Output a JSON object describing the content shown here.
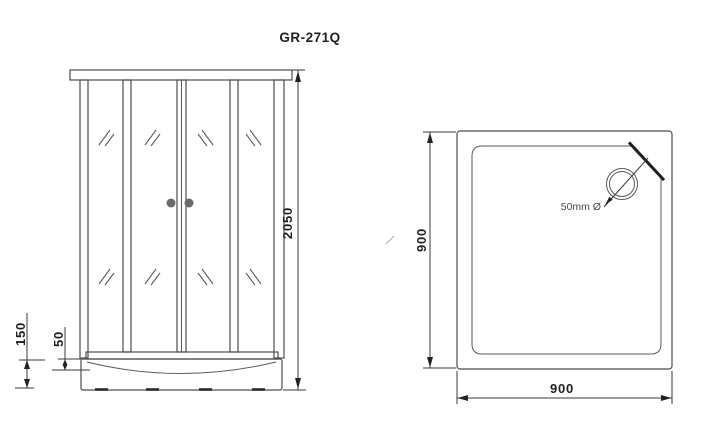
{
  "title": "GR-271Q",
  "front_view": {
    "height_dim": "2050",
    "tray_height_dim": "150",
    "tray_rim_dim": "50"
  },
  "top_view": {
    "width_dim": "900",
    "depth_dim": "900",
    "drain_label": "50mm Ø"
  },
  "colors": {
    "background": "#ffffff",
    "line": "#4d4d4d",
    "dim": "#222222",
    "text": "#1f1f1f",
    "knob": "#6b6b6b"
  }
}
